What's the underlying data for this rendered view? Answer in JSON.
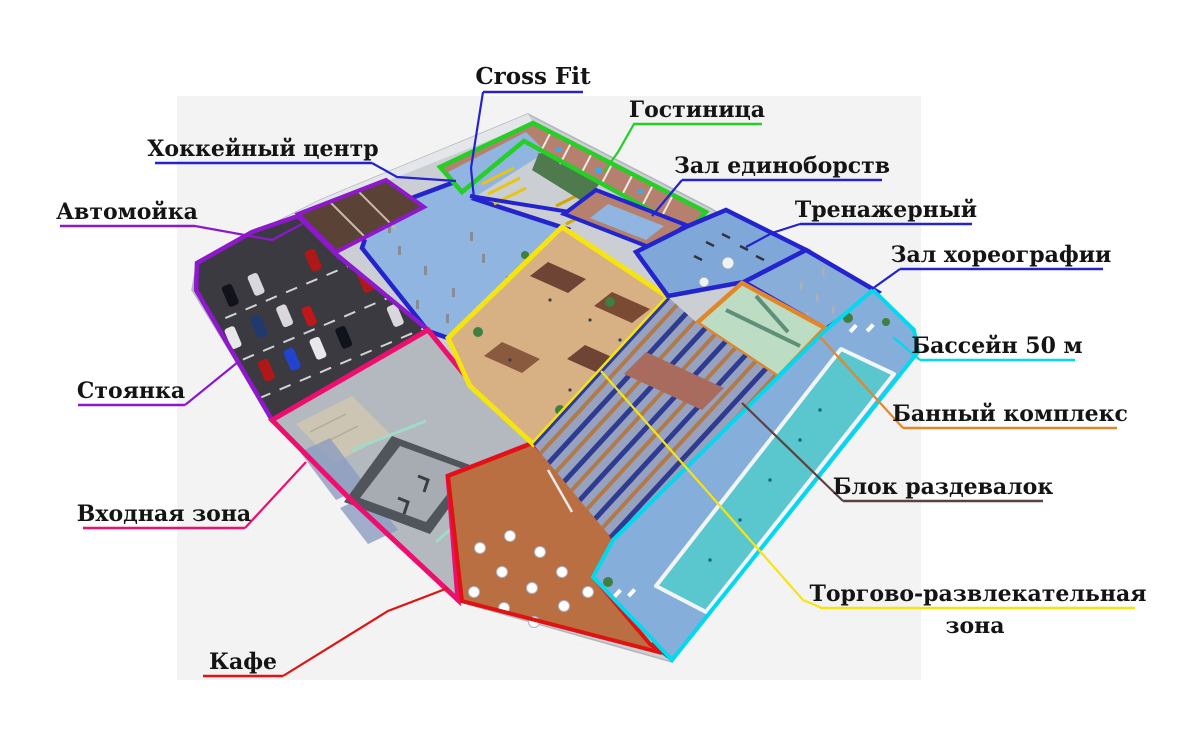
{
  "background": {
    "page": "#ffffff",
    "canvas": "#f3f3f4"
  },
  "labels": {
    "cross_fit": {
      "text": "Cross Fit",
      "color": "#2424cf"
    },
    "hotel": {
      "text": "Гостиница",
      "color": "#25cf25"
    },
    "hockey_center": {
      "text": "Хоккейный центр",
      "color": "#2424cf"
    },
    "car_wash": {
      "text": "Автомойка",
      "color": "#8d18cc"
    },
    "martial_arts": {
      "text": "Зал единоборств",
      "color": "#2424cf"
    },
    "gym": {
      "text": "Тренажерный",
      "color": "#2424cf"
    },
    "choreography": {
      "text": "Зал хореографии",
      "color": "#2424cf"
    },
    "pool": {
      "text": "Бассейн 50 м",
      "color": "#00d9ee"
    },
    "parking": {
      "text": "Стоянка",
      "color": "#8d18cc"
    },
    "bath": {
      "text": "Банный комплекс",
      "color": "#e2862a"
    },
    "lockers": {
      "text": "Блок раздевалок",
      "color": "#5e4040"
    },
    "entrance": {
      "text": "Входная зона",
      "color": "#ee0e6e"
    },
    "retail": {
      "line1": "Торгово-развлекательная",
      "line2": "зона",
      "color": "#f6e411"
    },
    "cafe": {
      "text": "Кафе",
      "color": "#e01212"
    }
  }
}
